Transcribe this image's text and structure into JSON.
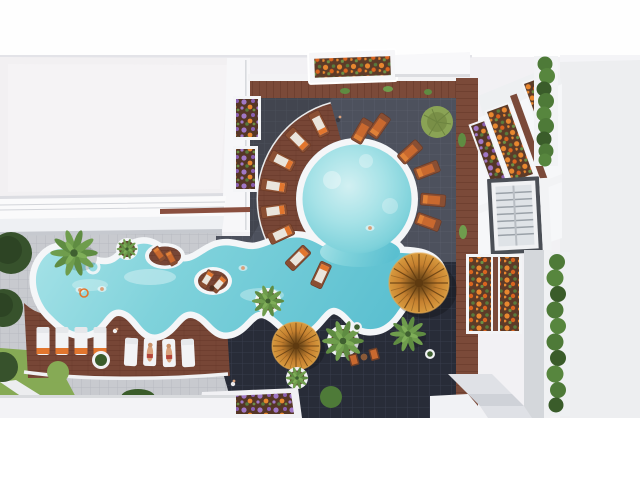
{
  "scene": {
    "type": "architectural-aerial-render",
    "subject": "Resort courtyard with freeform swimming pool seen from directly above",
    "view": "top-down aerial",
    "setting": "white apartment buildings around a pool deck with loungers, palms and planters"
  },
  "palette": {
    "canvas": "#f2f1f4",
    "right_bg": "#edeef0",
    "band_top": "#fefefe",
    "band_bottom": "#ffffff",
    "roof": "#f2f0f2",
    "roof_edge": "#dcdde2",
    "wall": "#f7f7f9",
    "terrace": "#fafafb",
    "terrace_lower": "#eef0f3",
    "rail_wood": "#8a4f3f",
    "paver": "#c8cacf",
    "paver_line": "#b3b6bd",
    "path_light": "#ecedef",
    "grass": "#86aa55",
    "tile": "#4d515d",
    "tile_line": "#5a5e6c",
    "tile_dark": "#282c38",
    "tile_dark_line": "#3a3f4f",
    "wood": "#7b4a39",
    "wood_line": "#633527",
    "deck": "#774636",
    "deck_line": "#623224",
    "rim": "#f4f6f8",
    "water_pale": "#d2f0f2",
    "water_light": "#a6e2e7",
    "water_mid": "#7fd2db",
    "water_deep": "#5abfd0",
    "thatch_light": "#d89a3e",
    "thatch_mid": "#c5802f",
    "thatch_dark": "#7d521c",
    "thatch_core": "#5e3a10",
    "lounger": "#f2f3f5",
    "lounger_edge": "#d5d8dd",
    "towel": "#e2762e",
    "wood_furniture": "#8a4f33",
    "cushion": "#eae5dc",
    "cushion_orange": "#c9692f",
    "flower_orange": "#e8872f",
    "flower_orange_deep": "#d9641f",
    "flower_purple": "#a077c6",
    "flower_purple_deep": "#8a5fb0",
    "flower_leaf": "#5a7a3c",
    "flower_leaf_light": "#6d8f45",
    "soil": "#5d3b28",
    "soil_dark": "#553626",
    "hedge": "#4e7a38",
    "hedge_dark": "#3a5c2a",
    "hedge_light": "#57863e",
    "palm": "#5f8c42",
    "palm_light": "#6f9d4d",
    "palm_core": "#3f6030",
    "tree": "#37522c",
    "tree_dark": "#2d4424",
    "bush_olive": "#8aa355",
    "window_frame": "#4b4f56",
    "window_pane": "#dfe3e7",
    "window_slat": "#9aa1a8",
    "concrete": "#d4d7db",
    "step": "#dfe1e6",
    "step_dark": "#cfd2d8",
    "skin": "#d9a07a"
  },
  "pool": {
    "shape": "freeform lazy-river channel joined to a circular lagoon",
    "features": [
      "scalloped white coping",
      "deck peninsulas with loungers",
      "planted round islands",
      "thatched parasols at the water edge"
    ],
    "swimmers": 4
  },
  "furniture": {
    "white_loungers_with_towels": 4,
    "white_loungers_center": 4,
    "wood_loungers_arc": 8,
    "wood_loungers_right": 4,
    "orange_loungers_top": 2,
    "island_loungers": 4,
    "thatch_parasols": 2
  },
  "flora": {
    "palm_trees": 5,
    "round_trees": 3,
    "hedge_columns": 2,
    "flower_planters": 7,
    "lawn_patches": 2
  },
  "buildings": {
    "left": "white apartment block roof with terrace bands",
    "right": "white facade with balcony flower boxes and a framed window",
    "materials": [
      "dark slate tile deck",
      "reddish wood deck",
      "light stone pavers"
    ]
  }
}
